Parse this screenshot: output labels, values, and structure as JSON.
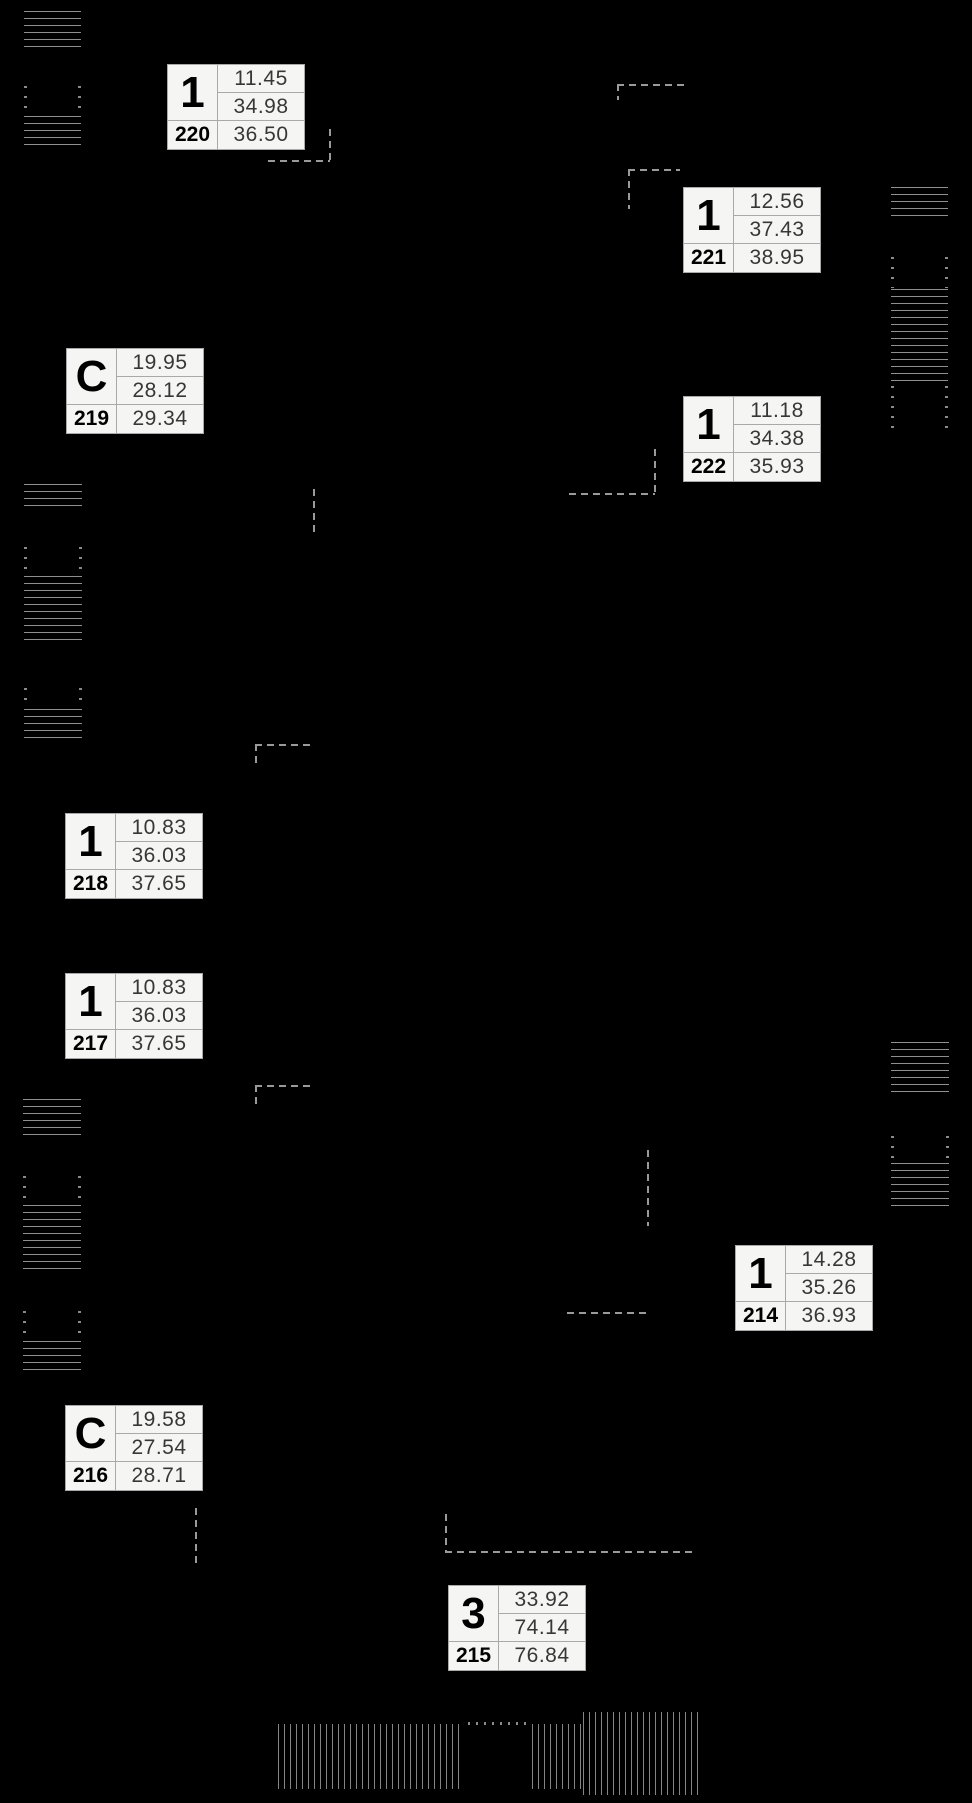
{
  "meta": {
    "width": 972,
    "height": 1803,
    "background_color": "#000000",
    "label_background_color": "#f5f5f3",
    "label_border_color": "#a9a9a9",
    "hatch_line_color": "#8f8f8f",
    "dashed_line_color": "#9a9a9a"
  },
  "units": [
    {
      "id": "220",
      "type": "1",
      "areas": [
        "11.45",
        "34.98",
        "36.50"
      ],
      "x": 167,
      "y": 64
    },
    {
      "id": "221",
      "type": "1",
      "areas": [
        "12.56",
        "37.43",
        "38.95"
      ],
      "x": 683,
      "y": 187
    },
    {
      "id": "219",
      "type": "C",
      "areas": [
        "19.95",
        "28.12",
        "29.34"
      ],
      "x": 66,
      "y": 348
    },
    {
      "id": "222",
      "type": "1",
      "areas": [
        "11.18",
        "34.38",
        "35.93"
      ],
      "x": 683,
      "y": 396
    },
    {
      "id": "218",
      "type": "1",
      "areas": [
        "10.83",
        "36.03",
        "37.65"
      ],
      "x": 65,
      "y": 813
    },
    {
      "id": "217",
      "type": "1",
      "areas": [
        "10.83",
        "36.03",
        "37.65"
      ],
      "x": 65,
      "y": 973
    },
    {
      "id": "214",
      "type": "1",
      "areas": [
        "14.28",
        "35.26",
        "36.93"
      ],
      "x": 735,
      "y": 1245
    },
    {
      "id": "216",
      "type": "C",
      "areas": [
        "19.58",
        "27.54",
        "28.71"
      ],
      "x": 65,
      "y": 1405
    },
    {
      "id": "215",
      "type": "3",
      "areas": [
        "33.92",
        "74.14",
        "76.84"
      ],
      "x": 448,
      "y": 1585
    }
  ],
  "hatches": [
    {
      "x": 24,
      "y": 11,
      "w": 57,
      "h": 38,
      "kind": "h-lines"
    },
    {
      "x": 24,
      "y": 86,
      "w": 57,
      "h": 28,
      "kind": "dot-cols"
    },
    {
      "x": 24,
      "y": 116,
      "w": 57,
      "h": 33,
      "kind": "h-lines"
    },
    {
      "x": 24,
      "y": 484,
      "w": 58,
      "h": 24,
      "kind": "h-lines"
    },
    {
      "x": 24,
      "y": 547,
      "w": 58,
      "h": 26,
      "kind": "dot-cols"
    },
    {
      "x": 24,
      "y": 576,
      "w": 58,
      "h": 70,
      "kind": "h-lines"
    },
    {
      "x": 24,
      "y": 688,
      "w": 58,
      "h": 18,
      "kind": "dot-cols"
    },
    {
      "x": 24,
      "y": 709,
      "w": 58,
      "h": 34,
      "kind": "h-lines"
    },
    {
      "x": 23,
      "y": 1099,
      "w": 58,
      "h": 40,
      "kind": "h-lines"
    },
    {
      "x": 23,
      "y": 1176,
      "w": 58,
      "h": 28,
      "kind": "dot-cols"
    },
    {
      "x": 23,
      "y": 1205,
      "w": 58,
      "h": 68,
      "kind": "h-lines"
    },
    {
      "x": 23,
      "y": 1311,
      "w": 58,
      "h": 28,
      "kind": "dot-cols"
    },
    {
      "x": 23,
      "y": 1341,
      "w": 58,
      "h": 34,
      "kind": "h-lines"
    },
    {
      "x": 891,
      "y": 187,
      "w": 57,
      "h": 33,
      "kind": "h-lines"
    },
    {
      "x": 891,
      "y": 257,
      "w": 57,
      "h": 31,
      "kind": "dot-cols"
    },
    {
      "x": 891,
      "y": 289,
      "w": 57,
      "h": 94,
      "kind": "h-lines"
    },
    {
      "x": 891,
      "y": 386,
      "w": 57,
      "h": 42,
      "kind": "dot-cols"
    },
    {
      "x": 891,
      "y": 1042,
      "w": 58,
      "h": 54,
      "kind": "h-lines"
    },
    {
      "x": 891,
      "y": 1136,
      "w": 58,
      "h": 23,
      "kind": "dot-cols"
    },
    {
      "x": 891,
      "y": 1163,
      "w": 58,
      "h": 46,
      "kind": "h-lines"
    },
    {
      "x": 278,
      "y": 1724,
      "w": 186,
      "h": 65,
      "kind": "v-lines"
    },
    {
      "x": 468,
      "y": 1722,
      "w": 60,
      "h": 3,
      "kind": "dot-row"
    },
    {
      "x": 532,
      "y": 1724,
      "w": 51,
      "h": 65,
      "kind": "v-lines"
    },
    {
      "x": 583,
      "y": 1712,
      "w": 117,
      "h": 83,
      "kind": "v-lines"
    }
  ],
  "dashes": [
    {
      "x": 268,
      "y": 160,
      "len": 62,
      "o": "h"
    },
    {
      "x": 329,
      "y": 129,
      "len": 32,
      "o": "v"
    },
    {
      "x": 617,
      "y": 84,
      "len": 70,
      "o": "h"
    },
    {
      "x": 617,
      "y": 84,
      "len": 16,
      "o": "v"
    },
    {
      "x": 628,
      "y": 169,
      "len": 52,
      "o": "h"
    },
    {
      "x": 628,
      "y": 169,
      "len": 40,
      "o": "v"
    },
    {
      "x": 654,
      "y": 449,
      "len": 46,
      "o": "v"
    },
    {
      "x": 569,
      "y": 493,
      "len": 86,
      "o": "h"
    },
    {
      "x": 313,
      "y": 489,
      "len": 46,
      "o": "v"
    },
    {
      "x": 255,
      "y": 744,
      "len": 55,
      "o": "h"
    },
    {
      "x": 255,
      "y": 744,
      "len": 19,
      "o": "v"
    },
    {
      "x": 255,
      "y": 1085,
      "len": 55,
      "o": "h"
    },
    {
      "x": 255,
      "y": 1085,
      "len": 19,
      "o": "v"
    },
    {
      "x": 647,
      "y": 1150,
      "len": 76,
      "o": "v"
    },
    {
      "x": 567,
      "y": 1312,
      "len": 80,
      "o": "h"
    },
    {
      "x": 195,
      "y": 1508,
      "len": 58,
      "o": "v"
    },
    {
      "x": 445,
      "y": 1514,
      "len": 38,
      "o": "v"
    },
    {
      "x": 445,
      "y": 1551,
      "len": 250,
      "o": "h"
    }
  ]
}
